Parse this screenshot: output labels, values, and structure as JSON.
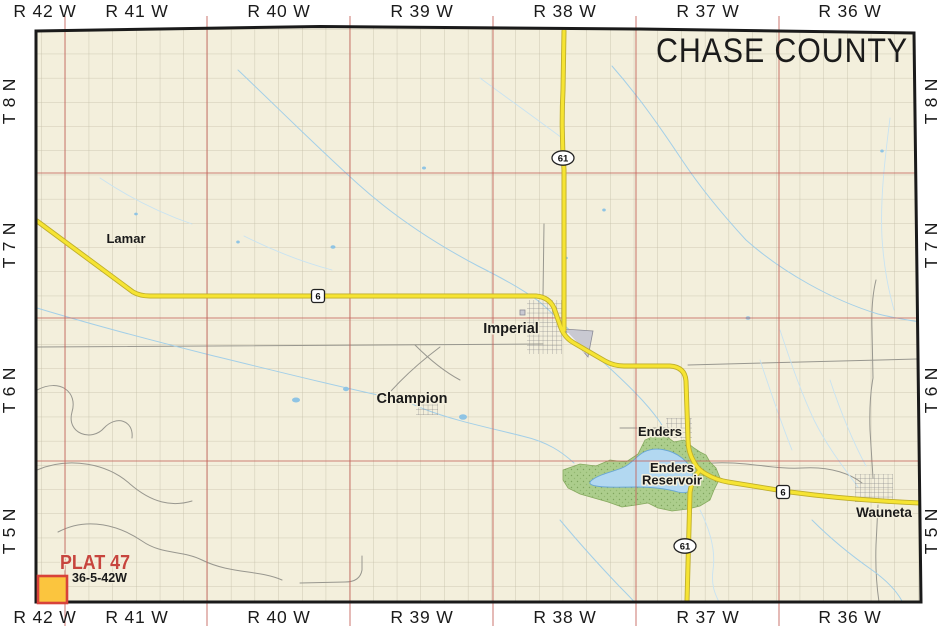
{
  "title": "CHASE COUNTY",
  "map_colors": {
    "background": "#f3efdc",
    "border": "#1a1a1a",
    "section_grid": "#c3bea8",
    "township_line": "#c4635b",
    "highway": "#f6e433",
    "road": "#98978f",
    "water": "#a3cfe8",
    "park": "#accd8c",
    "urban": "#c9c9d2"
  },
  "edge_labels": {
    "ranges_top": [
      "R 42 W",
      "R 41 W",
      "R 40 W",
      "R 39 W",
      "R 38 W",
      "R 37 W",
      "R 36 W"
    ],
    "ranges_bottom": [
      "R 42 W",
      "R 41 W",
      "R 40 W",
      "R 39 W",
      "R 38 W",
      "R 37 W",
      "R 36 W"
    ],
    "townships_left": [
      "T 8 N",
      "T 7 N",
      "T 6 N",
      "T 5 N"
    ],
    "townships_right": [
      "T 8 N",
      "T 7 N",
      "T 6 N",
      "T 5 N"
    ]
  },
  "towns": [
    {
      "name": "Lamar",
      "x": 126,
      "y": 243,
      "size": 13
    },
    {
      "name": "Imperial",
      "x": 511,
      "y": 333,
      "size": 14.5
    },
    {
      "name": "Champion",
      "x": 412,
      "y": 403,
      "size": 14.5
    },
    {
      "name": "Enders",
      "x": 660,
      "y": 436,
      "size": 13
    },
    {
      "name": "Wauneta",
      "x": 884,
      "y": 517,
      "size": 13.5
    }
  ],
  "water_labels": [
    {
      "lines": [
        "Enders",
        "Reservoir"
      ],
      "x": 672,
      "y": 472,
      "line_height": 12.5,
      "size": 13
    }
  ],
  "highway_shields": [
    {
      "route": "61",
      "shape": "ellipse",
      "x": 563,
      "y": 158
    },
    {
      "route": "6",
      "shape": "square",
      "x": 318,
      "y": 296
    },
    {
      "route": "6",
      "shape": "square",
      "x": 783,
      "y": 492
    },
    {
      "route": "61",
      "shape": "ellipse",
      "x": 685,
      "y": 546
    }
  ],
  "plat_marker": {
    "label": "PLAT 47",
    "code": "36-5-42W",
    "label_color": "#c7453e",
    "square_fill": "#fbc53e",
    "square_stroke": "#d8423a"
  }
}
